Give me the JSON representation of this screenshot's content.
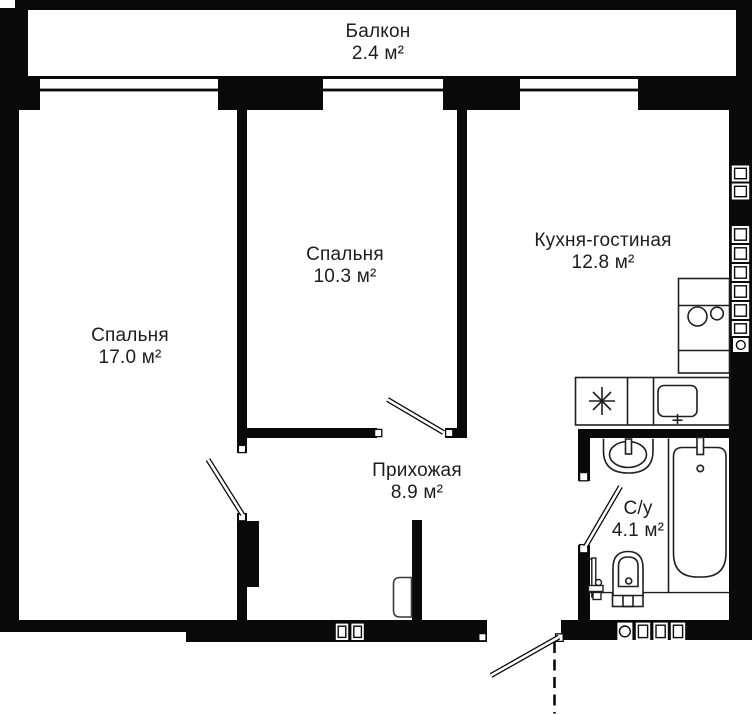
{
  "plan": {
    "rooms": [
      {
        "id": "balcony",
        "name": "Балкон",
        "area": "2.4 м²"
      },
      {
        "id": "bedroom-1",
        "name": "Спальня",
        "area": "17.0 м²"
      },
      {
        "id": "bedroom-2",
        "name": "Спальня",
        "area": "10.3 м²"
      },
      {
        "id": "kitchen-living",
        "name": "Кухня-гостиная",
        "area": "12.8 м²"
      },
      {
        "id": "hallway",
        "name": "Прихожая",
        "area": "8.9 м²"
      },
      {
        "id": "bathroom",
        "name": "С/у",
        "area": "4.1 м²"
      }
    ],
    "colors": {
      "wall": "#0a0a0a",
      "background": "#ffffff",
      "fixture_stroke": "#1f1f1f",
      "text": "#1d1d1d"
    }
  }
}
